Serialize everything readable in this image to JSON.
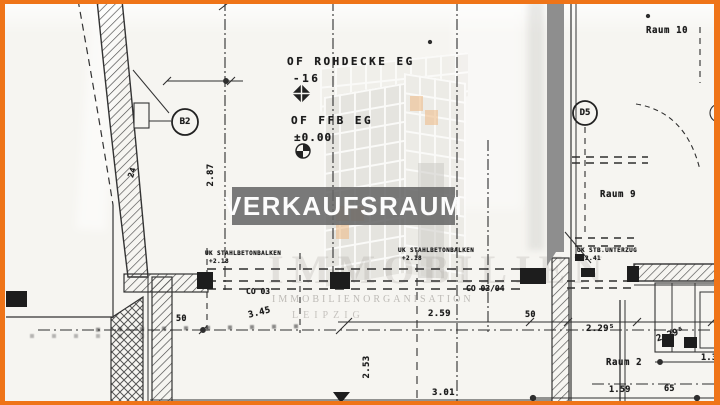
{
  "plan": {
    "banner": {
      "label": "VERKAUFSRAUM"
    },
    "levels": {
      "line1_label": "OF ROHDECKE EG",
      "line1_value": "-16",
      "line2_label": "OF FFB EG",
      "line2_value": "±0.00"
    },
    "rooms": {
      "raum10": "Raum 10",
      "raum9": "Raum 9",
      "raum2": "Raum 2"
    },
    "axis_markers": {
      "b2": "B2",
      "d5": "D5"
    },
    "beams": {
      "balken1": "UK STAHLBETONBALKEN",
      "balken1_level": "+2.18",
      "balken2": "UK STAHLBETONBALKEN",
      "balken2_level": "+2.18",
      "unterzug": "UK STB.UNTERZUG",
      "unterzug_level": "+2.41",
      "co1": "CO 03",
      "co2": "CO 03/04"
    },
    "dimensions": {
      "d287": "2.87",
      "d24": "24",
      "d50a": "50",
      "d345": "3.45",
      "d259": "2.59",
      "d50b": "50",
      "d229": "2.29⁵",
      "d253": "2.53",
      "d301": "3.01",
      "d159": "1.59",
      "d65": "65",
      "d135": "1.35"
    },
    "watermark": {
      "big": "IMMOBILIEN",
      "line1": "IMMOBILIENORGANISATION",
      "line2": "LEIPZIG"
    },
    "colors": {
      "frame": "#ef7418",
      "paper": "#f6f5f1",
      "scan_bar": "#8e8e8e",
      "ink": "#222222",
      "banner_bg": "#686868",
      "logo_accent": "#e8821f"
    }
  }
}
